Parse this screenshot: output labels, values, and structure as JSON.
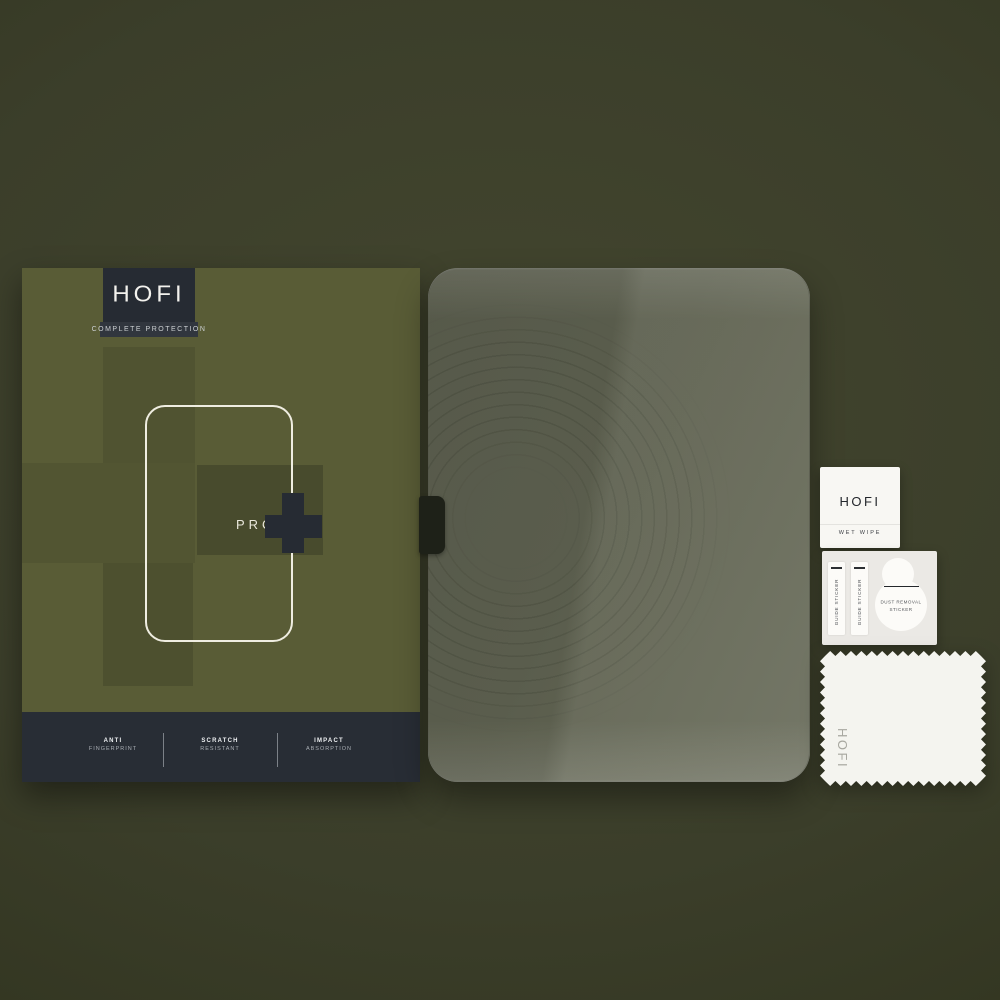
{
  "product": {
    "box": {
      "brand": "HOFI",
      "tagline": "COMPLETE PROTECTION",
      "model": "PRO",
      "features": [
        {
          "line1": "ANTI",
          "line2": "FINGERPRINT"
        },
        {
          "line1": "SCRATCH",
          "line2": "RESISTANT"
        },
        {
          "line1": "IMPACT",
          "line2": "ABSORPTION"
        }
      ]
    },
    "accessories": {
      "wet_wipe": {
        "brand": "HOFI",
        "label": "WET WIPE"
      },
      "guide_sticker_1": "GUIDE STICKER",
      "guide_sticker_2": "GUIDE STICKER",
      "dust_removal_line1": "DUST REMOVAL",
      "dust_removal_line2": "STICKER",
      "cloth_brand": "HOFI"
    },
    "colors": {
      "background_olive": "#3a3d29",
      "box_olive": "#595c36",
      "camo_shade_dark": "#4d502f",
      "camo_shade_mid": "#525532",
      "camo_shade_grey": "#484b2d",
      "dark_navy": "#262b33",
      "cream_outline": "#efede1",
      "glass_olive": "#5f6251",
      "accessory_white": "#f8f7f3"
    }
  }
}
